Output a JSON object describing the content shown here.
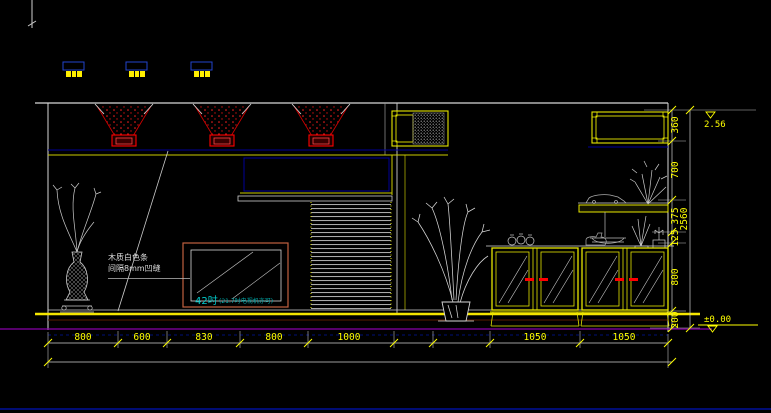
{
  "drawing": {
    "type": "interior-elevation-cad",
    "background": "#000000"
  },
  "dimensions": {
    "bottom": [
      "800",
      "600",
      "830",
      "800",
      "1000",
      "1050",
      "1050"
    ],
    "right": [
      "360",
      "700",
      "375",
      "125",
      "800",
      "200"
    ],
    "total_height": "2560"
  },
  "levels": {
    "top": "2.56",
    "bottom": "±0.00"
  },
  "notes": {
    "wall_note_line1": "木质白色条",
    "wall_note_line2": "间隔8mm凹缝",
    "tv_size": "42吋",
    "tv_note": "(21.7吋电视机亦可)"
  },
  "colors": {
    "outline_white": "#d8d8d8",
    "dim_yellow": "#ffff00",
    "accent_red": "#ff0000",
    "ceiling_navy": "#000099",
    "floor_magenta": "#8800aa",
    "floor_dark_red": "#5a1d00",
    "tv_frame_orange": "#c06040",
    "tv_text_cyan": "#00cccc"
  }
}
